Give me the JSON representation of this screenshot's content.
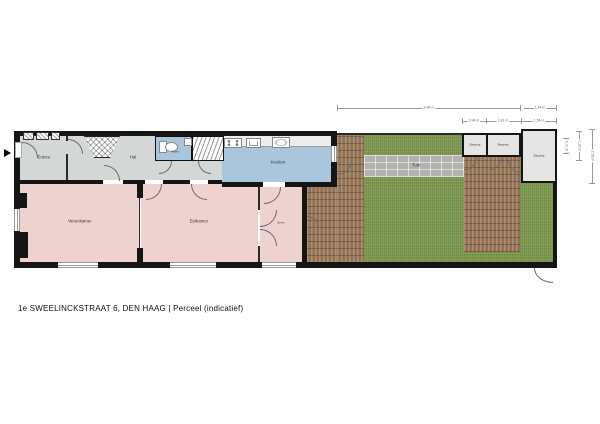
{
  "caption": "1e SWEELINCKSTRAAT 6, DEN HAAG  | Perceel  (indicatief)",
  "rooms": {
    "entree": "Entree",
    "hal": "Hal",
    "toilet": "Toilet",
    "keuken": "Keuken",
    "woonkamer": "Woonkamer",
    "eetkamer": "Eetkamer",
    "serre": "Serre",
    "tuin": "Tuin",
    "berging_1": "Berging",
    "berging_2": "Berging",
    "berging_3": "Berging"
  },
  "dimensions": {
    "top_main": "9,94 m",
    "top_right": "1,54 m",
    "berging_row": [
      "0,94 m",
      "1,41 m",
      "1,54 m"
    ],
    "side": [
      "0,71 m",
      "1,16 m",
      "2,35 m"
    ]
  },
  "colors": {
    "hall_floor": "#d3d7d6",
    "living_floor": "#eed2cf",
    "kitchen_floor": "#a9c6dd",
    "storage_floor": "#e5e5e5",
    "grass": "#7e9a50",
    "deck_wood": "#a17f60",
    "garden_path": "#b2b2b0",
    "wall": "#151515"
  }
}
